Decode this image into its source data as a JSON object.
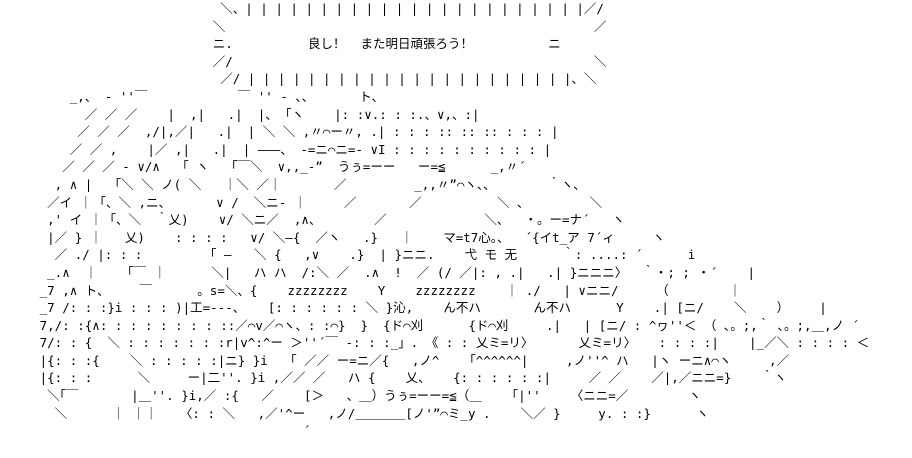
{
  "colors": {
    "background": "#ffffff",
    "text": "#000000"
  },
  "speech_bubble": {
    "text": "良し！  また明日頑張ろう！",
    "style": "shout-burst of vertical tick marks"
  },
  "scene": {
    "description": "Japanese ASCII art (2ch AA style): characters asleep under a blanket saying zzzzzzzz, with a sign board and a large round figure at right",
    "sound_effects": [
      "zzzzzzzz",
      "zzzzzzzz",
      "うぅ=ーー",
      "ー=≦",
      "うぅ=ーー=≦"
    ]
  },
  "ascii_art": {
    "lines": [
      "                             ＼、| | | | | | | | | | | | | | | | | | | | | | |／/",
      "                            ＼                                                 ／",
      "                            ニ.          良し！  また明日頑張ろう！          ニ",
      "                            ／/                                                ＼",
      "                             ／/ | | | | | | | | | | | | | | | | | | | | | |、＼",
      "         _,、 ‐ ''￣            ￣ '' ‐ 、、      ト、",
      "           ／ ／ ／    |  ,|   .|  |、 ｢ヽ    |: :∨.: : :.、∨,、:|",
      "          ／ ／ ／  ,/|,／|   .|  | ＼ ＼ ,〃⌒ー〃, .| : : : :: :: :: : : : |",
      "         ／ ／ ,    |／ ,|   .|  | ―――、 -=ニ⌒ニ=- ∨I : : : : : : : : : : |",
      "        ／ ／ ／ - ∨/∧   ｢ ヽ   ｢￣＼  ∨,,_-”  うぅ=ーー   ー=≦      _,〃´",
      "       , ∧ |   ｢＼ ＼ ノ( ＼   ｜＼ ／｜       ／         _,,〃”⌒ヽ、、       ｀ヽ、",
      "      ／イ ｜ ｢、＼ ,ニ、      ∨ /  ＼ニ‐ ｜     ／       ／          ＼ 、        ＼",
      "      ,' イ ｜ ｢、＼  ｀乂)    ∨/ ＼ニ／  ,∧、       ／             ＼、  ・。ー=ナ´   ヽ",
      "      |／ } ｜   乂)    : : : :   ∨/ ＼―{  ／ヽ   .}   ｜    マ=t7心。、  ´{イt_ア 7´ィ     ヽ",
      "       ／ ./ |: : :         ｢ ―   ＼ {   ,∨    .}  | }ニニ.    弋 モ 无      ｀: ....: ´      i",
      "      _.∧  ｜    ｢￣ ｜      ＼|   ハ ハ  /:＼ ／  .∧  !  ／ (/ ／|: , .|   .| }ニニニ〉  ｀・; ; ・´    |",
      "     _7 ,∧ ト、    ￣      。s=＼、{    zzzzzzzz    Y    zzzzzzzz    ｜ ./   | ∨ニニ/     （        ｜",
      "     _7 /: : :}i : : : )|工=---、   [: : : : : : ＼ }沁,    ん不ハ       ん不ハ      Y    .| [ニ/    ＼    ）    |",
      "     7,/: :{∧: : : : : : : : ::／⌒v／⌒ヽ、: :⌒}  }  {ド⌒刈      {ド⌒刈     .|   | [ニ/ : ^ヮ''＜ （ ､。;,｀ ､。;,＿,ノ ´",
      "     7/: : {  ＼ : : : : : : :r|v^:^ー ＞''´￣ ‐: : :_」. 《 : : 乂ミ=リ〉      乂ミ=リ〉   : : : :|    |_／＼ : : : : ＜       ／",
      "     |{: : :{    ＼ : : : : :|ニ} }i   ｢ ／／ ー=ニ／{   ,ノ^    ｢^^^^^^|     ,ノ''^ ハ   |ヽ ーニ∧⌒ヽ     ,／",
      "     |{: : :      ＼     ー|二''. }i ,／／ ／   ハ {    乂、   {: : : : : :|     ／ ／    ／|,／ニニ=}    ｀ヽ",
      "      ＼｢￣       |＿''. }i,／ :{   ／    [＞   、＿）うぅ=ーー=≦（＿    ｢|''    〈ニニ=／        ヽ",
      "       ＼      ｜ ｜｜   〈: : ＼   ,／'^ー   ,ノ/＿＿＿＿[ノ'”⌒ミ_y .    ＼／ }     y. : :}      ヽ",
      "                                        ´",
      ""
    ]
  }
}
